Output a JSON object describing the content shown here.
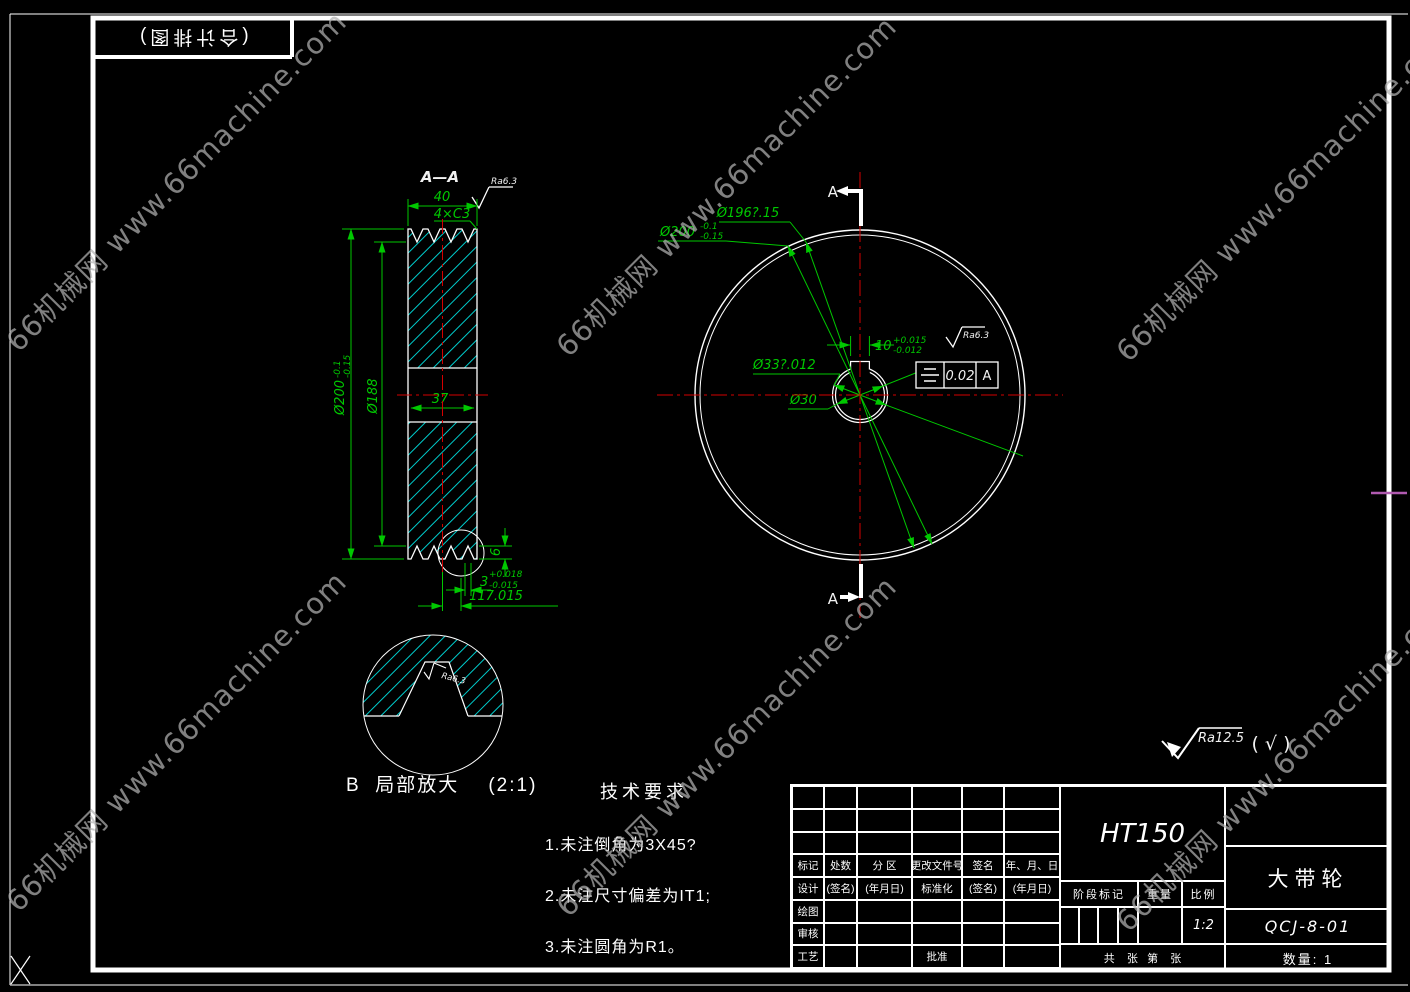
{
  "watermark": {
    "text": "66机械网 www.66machine.com"
  },
  "frame": {
    "corner_label": "(合计排图)"
  },
  "colors": {
    "dimension": "#00c800",
    "hatch": "#00cccc",
    "centerline": "#d40000",
    "line": "#ffffff",
    "watermark": "#b2b2b2",
    "magenta_mark": "#b05ab0"
  },
  "section_view": {
    "title": "A—A",
    "ra_top": "Ra6.3",
    "dim_width": "40",
    "dim_chamfer": "4×C3",
    "dim_outer_dia": {
      "base": "Ø200",
      "sup": "-0.1",
      "sub": "-0.15"
    },
    "dim_root_dia": "Ø188",
    "dim_hub": "37",
    "dim_groove_depth": "6",
    "dim_groove_width": {
      "base": "3",
      "sup": "+0.018",
      "sub": "-0.015"
    },
    "dim_groove_pitch": "117.015"
  },
  "front_view": {
    "section_label": "A",
    "dim_pitch_dia": "Ø196?.15",
    "dim_outer_dia": {
      "base": "Ø200",
      "sup": "-0.1",
      "sub": "-0.15"
    },
    "dim_bore": "Ø33?.012",
    "dim_inner": "Ø30",
    "dim_keyway": {
      "base": "10",
      "sup": "+0.015",
      "sub": "-0.012"
    },
    "ra_keyway": "Ra6.3",
    "tolerance_frame": {
      "symbol": "symmetry",
      "value": "0.02",
      "datum": "A"
    }
  },
  "detail_view": {
    "caption": "B  局部放大    (2:1)",
    "ra": "Ra6.3"
  },
  "surface_note": {
    "ra": "Ra12.5",
    "others": "( √ )"
  },
  "tech_req": {
    "title": "技术要求",
    "items": [
      "1.未注倒角为3X45?",
      "2.未注尺寸偏差为IT1;",
      "3.未注圆角为R1。"
    ]
  },
  "title_block": {
    "material": "HT150",
    "part_name": "大带轮",
    "drawing_no": "QCJ-8-01",
    "quantity": "数量: 1",
    "stage_label": "阶段标记",
    "weight_label": "重量",
    "scale_label": "比例",
    "scale_value": "1:2",
    "sheet_row": "共    张   第    张",
    "rev_rows": [
      [
        "",
        "",
        "",
        "",
        "",
        ""
      ],
      [
        "",
        "",
        "",
        "",
        "",
        ""
      ],
      [
        "",
        "",
        "",
        "",
        "",
        ""
      ],
      [
        "标记",
        "处数",
        "分 区",
        "更改文件号",
        "签名",
        "年、月、日"
      ],
      [
        "设计",
        "(签名)",
        "(年月日)",
        "标准化",
        "(签名)",
        "(年月日)"
      ],
      [
        "绘图",
        "",
        "",
        "",
        "",
        ""
      ],
      [
        "审核",
        "",
        "",
        "",
        "",
        ""
      ],
      [
        "工艺",
        "",
        "",
        "批准",
        "",
        ""
      ]
    ]
  }
}
